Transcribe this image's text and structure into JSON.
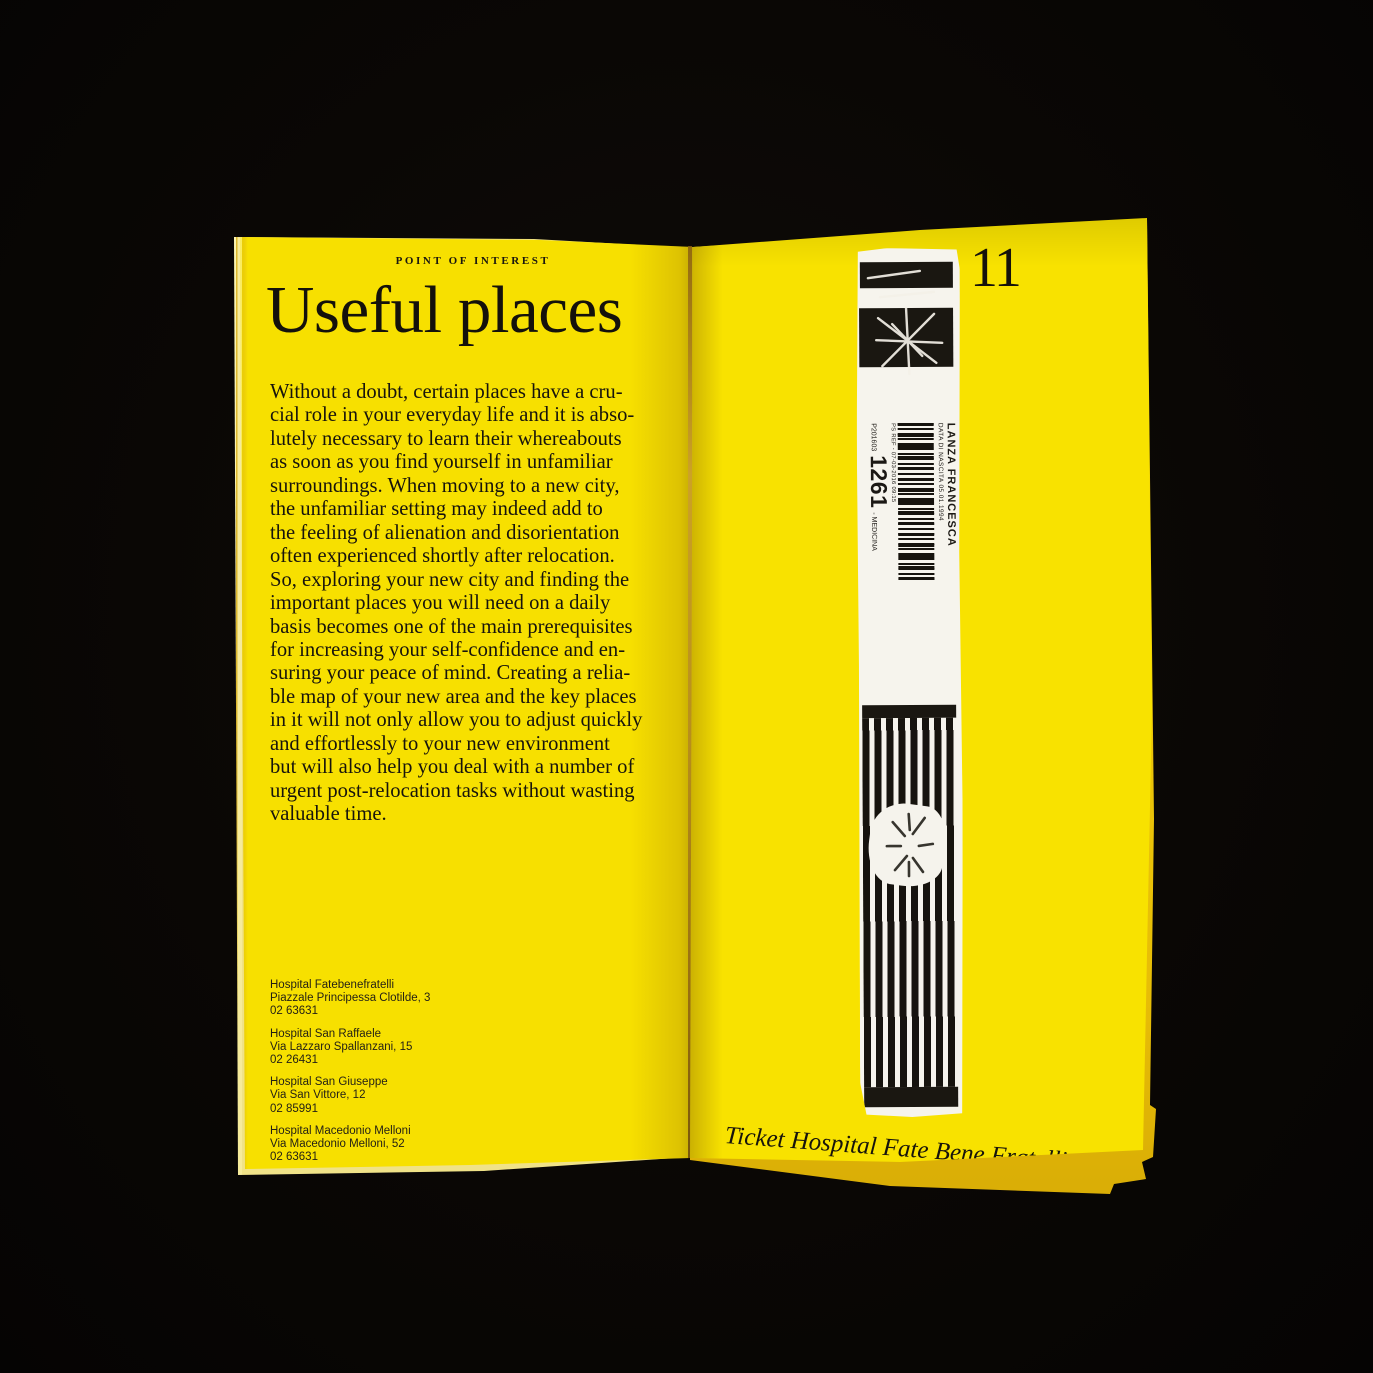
{
  "left_page": {
    "kicker": "POINT OF INTEREST",
    "title": "Useful places",
    "body": "Without a doubt, certain places have a cru-\ncial role in your everyday life and it is abso-\nlutely necessary to learn their whereabouts\nas soon as you find yourself in unfamiliar\nsurroundings. When moving to a new city,\nthe unfamiliar setting may indeed add to\nthe feeling of alienation and disorientation\noften experienced shortly after relocation.\nSo, exploring your new city and finding the\nimportant places you will need on a daily\nbasis becomes one of the main prerequisites\nfor increasing your self-confidence and en-\nsuring your peace of mind. Creating a relia-\nble map of your new area and the key places\nin it will not only allow you to adjust quickly\nand effortlessly to your new environment\nbut will also help you deal with a number of\nurgent post-relocation tasks without wasting\nvaluable time.",
    "hospitals": [
      {
        "name": "Hospital Fatebenefratelli",
        "address": "Piazzale Principessa Clotilde, 3",
        "phone": "02 63631"
      },
      {
        "name": "Hospital San Raffaele",
        "address": "Via Lazzaro Spallanzani, 15",
        "phone": "02 26431"
      },
      {
        "name": "Hospital San Giuseppe",
        "address": "Via San Vittore, 12",
        "phone": "02 85991"
      },
      {
        "name": "Hospital Macedonio Melloni",
        "address": "Via Macedonio Melloni, 52",
        "phone": "02 63631"
      }
    ]
  },
  "right_page": {
    "page_number": "11",
    "caption": "Ticket Hospital Fate Bene Fratelli",
    "ticket": {
      "patient_name": "LANZA FRANCESCA",
      "birth_date_line": "DATA DI NASCITA 05.01.1994",
      "ref_line": "PS REF - 07-03-2016 09:15",
      "code_prefix": "P201603",
      "code_number": "1261",
      "code_suffix": "- MEDICINA"
    }
  },
  "colors": {
    "background_black": "#0a0705",
    "paper_yellow": "#f7e000",
    "ink_black": "#17140e",
    "ticket_white": "#f6f4ed",
    "ticket_print_black": "#1a1711"
  }
}
